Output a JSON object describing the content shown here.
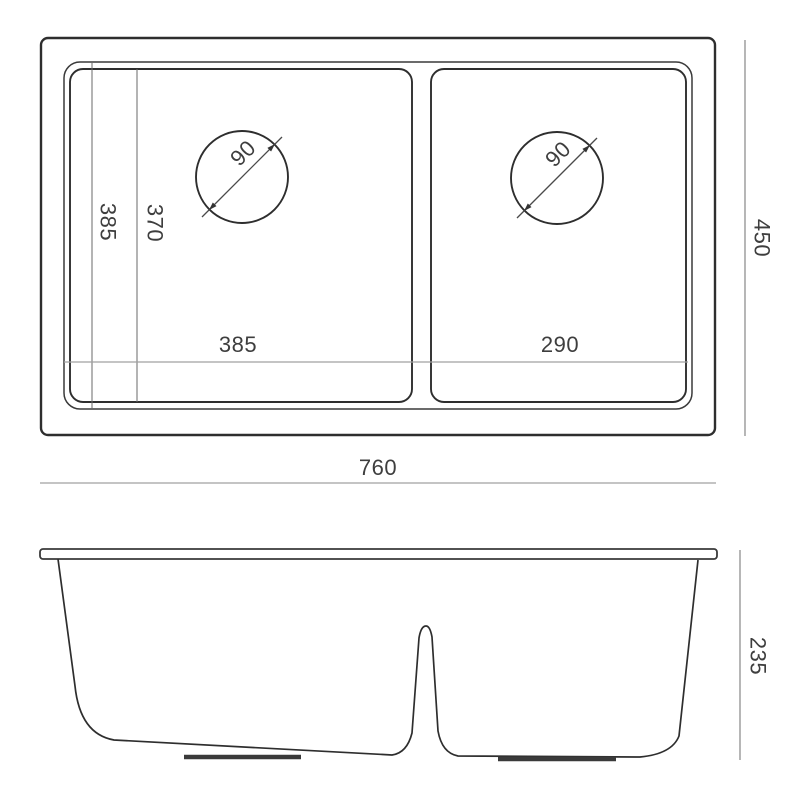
{
  "drawing": {
    "colors": {
      "background": "#ffffff",
      "outline": "#2e2e2e",
      "dimension_line": "#909090",
      "text": "#3e3e3e"
    },
    "top_view": {
      "labels": {
        "overall_width": "760",
        "overall_depth": "450",
        "inner_depth": "385",
        "bowl_depth": "370",
        "left_bowl_width": "385",
        "right_bowl_width": "290",
        "left_drain_diameter": "90",
        "right_drain_diameter": "90"
      }
    },
    "front_view": {
      "labels": {
        "bowl_height": "235"
      }
    }
  }
}
